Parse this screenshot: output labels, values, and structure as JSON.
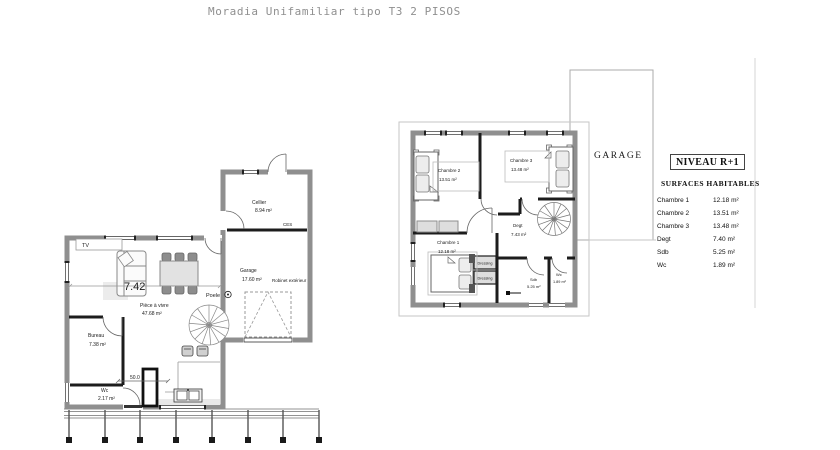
{
  "title": "Moradia Unifamiliar tipo T3 2 PISOS",
  "ground_floor": {
    "tv_label": "TV",
    "ces_label": "CES",
    "poele_label": "Poele",
    "robinet_label": "Robinet extérieur",
    "dim_width": "7.42",
    "dim_column": "50.0",
    "rooms": [
      {
        "name": "Cellier",
        "area": "8.94 m²"
      },
      {
        "name": "Garage",
        "area": "17.60 m²"
      },
      {
        "name": "Pièce à vivre",
        "area": "47.68 m²"
      },
      {
        "name": "Bureau",
        "area": "7.38 m²"
      },
      {
        "name": "Wc",
        "area": "2.17 m²"
      }
    ]
  },
  "upper_floor": {
    "garage_label": "GARAGE",
    "rooms": [
      {
        "name": "Chambre 2",
        "area": "13.51 m²"
      },
      {
        "name": "Chambre 3",
        "area": "13.48 m²"
      },
      {
        "name": "Degt",
        "area": "7.43 m²"
      },
      {
        "name": "Chambre 1",
        "area": "12.18 m²"
      },
      {
        "name": "Sdb",
        "area": "5.25 m²"
      },
      {
        "name": "Wc",
        "area": "1.89 m²"
      }
    ],
    "dressing_labels": [
      "Dressing",
      "Dressing"
    ]
  },
  "legend": {
    "title": "NIVEAU R+1",
    "subtitle": "SURFACES HABITABLES",
    "rows": [
      {
        "label": "Chambre 1",
        "value": "12.18 m²"
      },
      {
        "label": "Chambre 2",
        "value": "13.51 m²"
      },
      {
        "label": "Chambre 3",
        "value": "13.48 m²"
      },
      {
        "label": "Degt",
        "value": "7.40 m²"
      },
      {
        "label": "Sdb",
        "value": "5.25 m²"
      },
      {
        "label": "Wc",
        "value": "1.89 m²"
      }
    ]
  },
  "colors": {
    "wall_gray": "#8f8f8f",
    "partition_black": "#1c1c1c",
    "roof_outline": "#c6c6c6",
    "title_gray": "#8f8f8f"
  }
}
